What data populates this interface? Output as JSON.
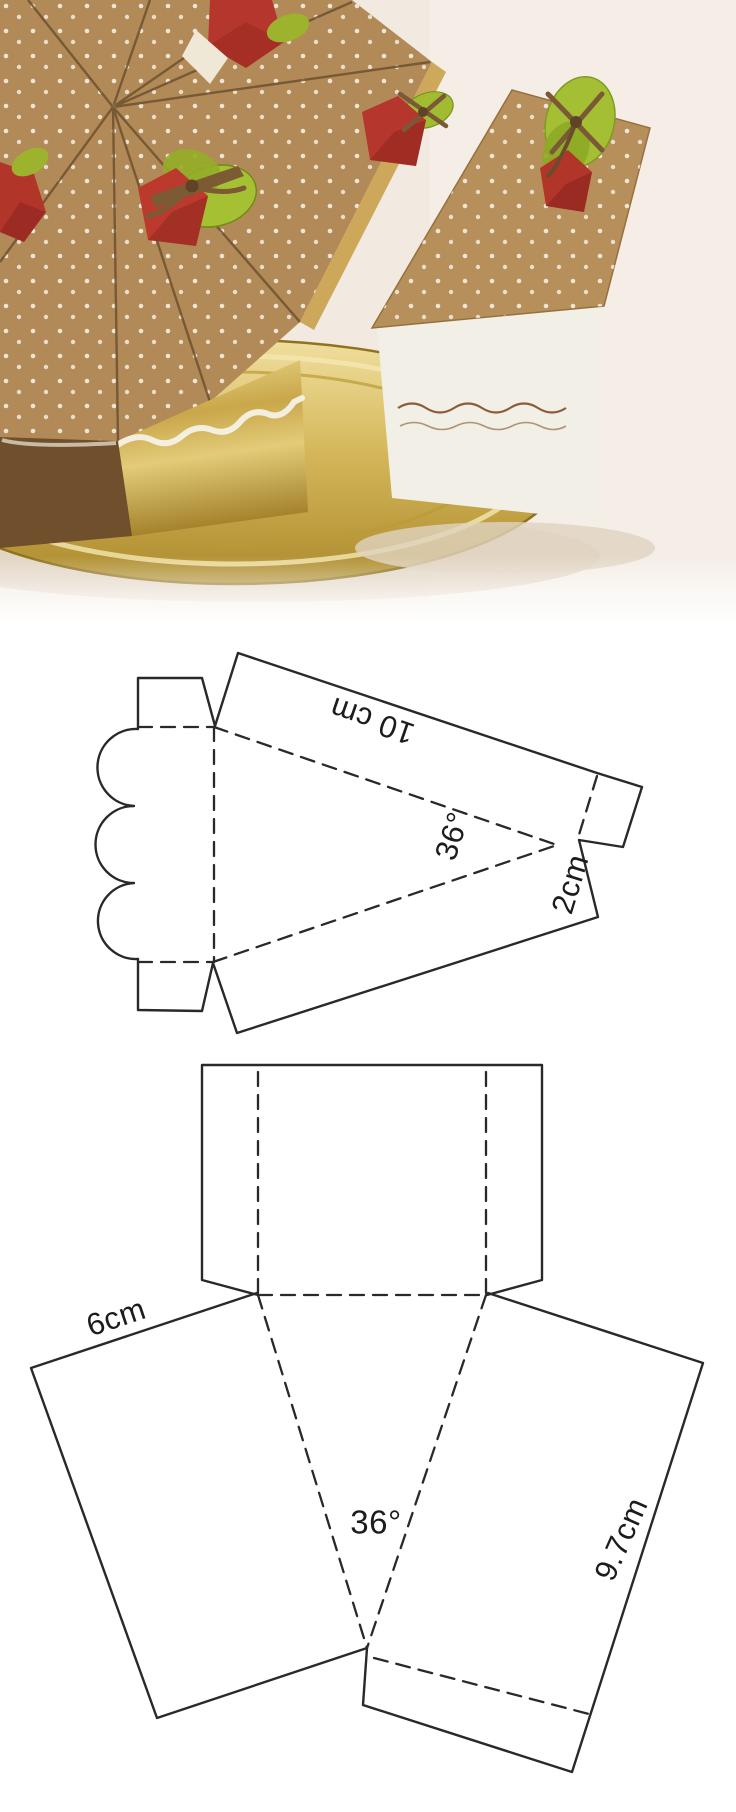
{
  "pin": {
    "kind": "cake-slice-gift-box-craft-template",
    "sections": [
      "photo",
      "slice-side-template",
      "slice-lid-template"
    ]
  },
  "photo": {
    "description_labels": [],
    "colors": {
      "background": "#f2eae1",
      "kraft_top": "#b28a57",
      "kraft_side_dark": "#6f4f2c",
      "gold_foil": "#c9a74a",
      "plate_gold": "#d2b254",
      "strawberry_red": "#b5362c",
      "leaf_green": "#a4bf33",
      "ribbon_brown": "#7b5836",
      "slice_white_side": "#f2efe6",
      "polka_dot": "#f4eddf"
    }
  },
  "slice_template": {
    "length_label": "10 cm",
    "angle_label": "36°",
    "flap_label": "2cm"
  },
  "lid_template": {
    "top_label": "6cm",
    "angle_label": "36°",
    "side_label": "9.7cm"
  },
  "style": {
    "line_color": "#2b2927",
    "template_background": "#ffffff"
  }
}
